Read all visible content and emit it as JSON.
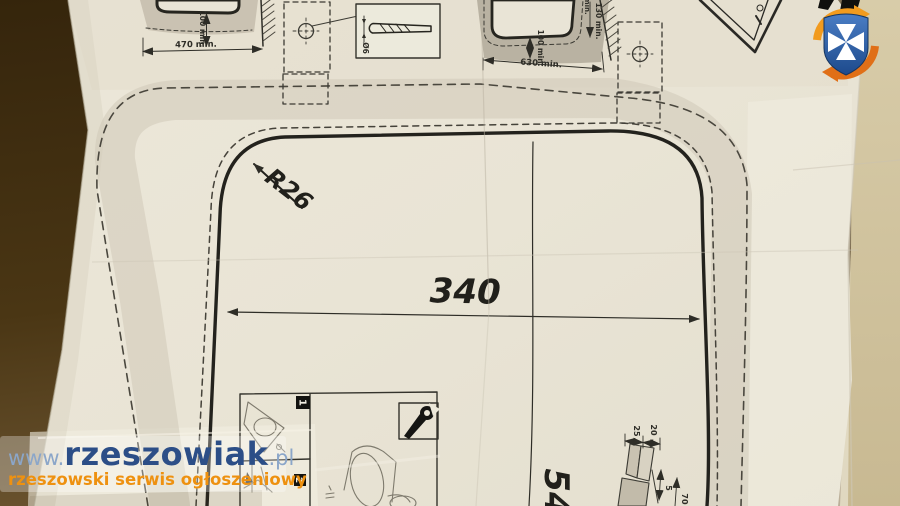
{
  "site_watermark": {
    "url_prefix": "www.",
    "brand": "rzeszowiak",
    "url_suffix": ".pl",
    "tagline": "rzeszowski serwis ogłoszeniowy",
    "brand_color": "#2c4e87",
    "url_color": "#8ba6c9",
    "tagline_color": "#ee9110"
  },
  "logo": {
    "name": "rzeszowiak-shield-logo",
    "shield_color": "#2e5ea3",
    "cross_color": "#ffffff",
    "arrow_top_color": "#f29b1e",
    "arrow_bottom_color": "#e06f17"
  },
  "template": {
    "main_cutout": {
      "width_label": "340",
      "height_label_partial": "54",
      "corner_radius_label": "R26"
    },
    "top_left_view": {
      "width_label": "470 min.",
      "depth_label": "100 min."
    },
    "drill_detail": {
      "diameter_label": "Ø6"
    },
    "top_right_view": {
      "width_label": "630 min.",
      "side_label": "130 min.",
      "depth_label": "100 min.",
      "partial_label": "min."
    },
    "install_steps": {
      "step1": "1",
      "step2": "2"
    },
    "section_detail": {
      "dim_25": "25",
      "dim_20": "20",
      "dim_5": "5",
      "dim_70": "70"
    }
  }
}
